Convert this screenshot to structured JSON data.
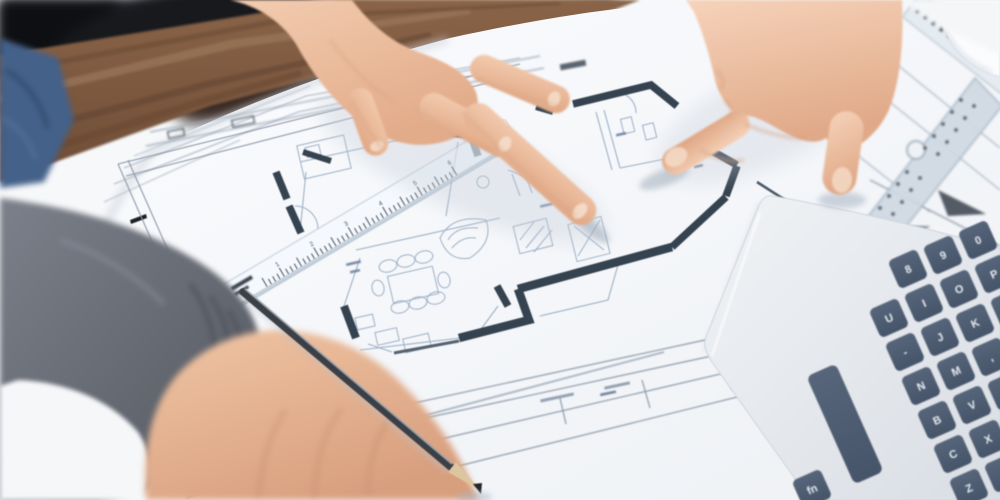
{
  "scene": {
    "type": "photograph",
    "description": "Two architects' hands over an architectural floor-plan blueprint on a wooden desk; one hand points at the plan, another rests on a transparent scale ruler, a blurred foreground hand holds a pencil, a laptop keyboard enters from the right, a set square and scale ruler lie at top right."
  },
  "objects": {
    "blueprint_label": "architectural floor plan drawing",
    "ruler_label": "transparent scale ruler",
    "setsquare_label": "set square",
    "pencil_label": "pencil",
    "laptop_label": "laptop keyboard",
    "table_label": "wooden desk edge"
  },
  "laptop": {
    "space_label": "",
    "keys": [
      "fn",
      "8",
      "9",
      "0",
      "U",
      "I",
      "O",
      "P",
      "-",
      "J",
      "K",
      "L",
      "N",
      "M",
      ",",
      "B",
      "V",
      ".",
      "C",
      "X",
      "Z",
      "⇧"
    ]
  },
  "ruler": {
    "numbers": [
      "1",
      "2",
      "3",
      "4",
      "5",
      "6"
    ]
  },
  "colors": {
    "wood": "#7d5a41",
    "paper": "#f7f9fb",
    "plan_wall": "#35424f",
    "plan_line": "#9db0c6",
    "key": "#4e5c6e",
    "skin": "#ecc1a3",
    "sweater": "#6a6e78",
    "denim": "#44618a"
  }
}
